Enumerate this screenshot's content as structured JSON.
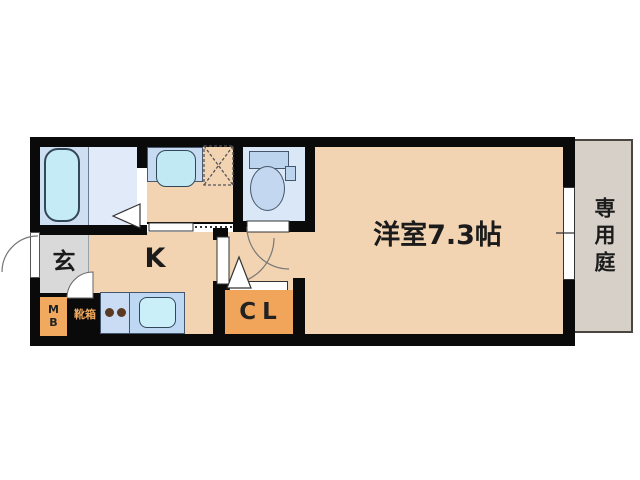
{
  "floorplan": {
    "rooms": {
      "main_room": {
        "label": "洋室7.3帖",
        "type": "western-style room, 7.3 tatami"
      },
      "kitchen": {
        "label": "K"
      },
      "entrance": {
        "label": "玄"
      },
      "closet": {
        "label": "CL"
      },
      "private_garden": {
        "label": "専用庭"
      },
      "meter_box": {
        "label": "MB"
      },
      "shoe_box": {
        "label": "靴箱"
      }
    },
    "fixtures": [
      "bathtub",
      "washbasin",
      "washing-machine-space",
      "toilet",
      "kitchen-stove-burners",
      "kitchen-sink",
      "sliding-door",
      "entry-door",
      "room-door",
      "folding-door",
      "garden-window"
    ],
    "colors": {
      "wall": "#0a0a0a",
      "floor_tatami": "#f2d3b2",
      "bath_floor": "#cfdff2",
      "water_fixture": "#c5ecf6",
      "counter": "#c6daf2",
      "accent_orange": "#f0a55a",
      "garden": "#d7d0c9",
      "entrance_floor": "#d9d9d9",
      "background": "#ffffff"
    }
  }
}
